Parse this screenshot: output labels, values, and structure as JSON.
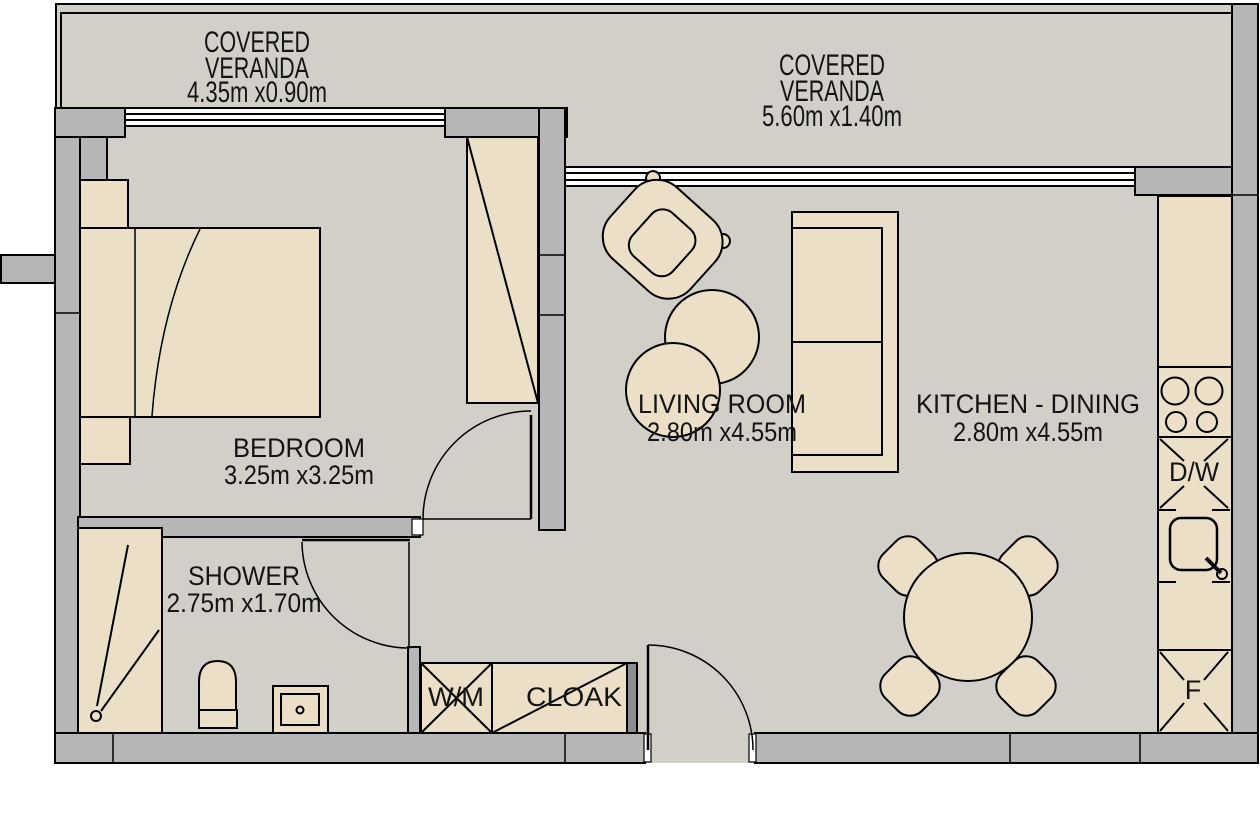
{
  "plan": {
    "verandas": [
      {
        "title_line1": "COVERED",
        "title_line2": "VERANDA",
        "dimensions": "4.35m x0.90m"
      },
      {
        "title_line1": "COVERED",
        "title_line2": "VERANDA",
        "dimensions": "5.60m x1.40m"
      }
    ],
    "rooms": [
      {
        "name": "BEDROOM",
        "dimensions": "3.25m x3.25m"
      },
      {
        "name": "LIVING ROOM",
        "dimensions": "2.80m x4.55m"
      },
      {
        "name": "KITCHEN - DINING",
        "dimensions": "2.80m x4.55m"
      },
      {
        "name": "SHOWER",
        "dimensions": "2.75m x1.70m"
      }
    ],
    "fixtures": {
      "washing_machine": "W/M",
      "cloakroom": "CLOAK",
      "dishwasher": "D/W",
      "fridge": "F"
    },
    "colors": {
      "background": "#ffffff",
      "floor": "#d2cfc9",
      "wall": "#b6b6b6",
      "furniture": "#ecdfc8",
      "outline": "#000000"
    }
  }
}
